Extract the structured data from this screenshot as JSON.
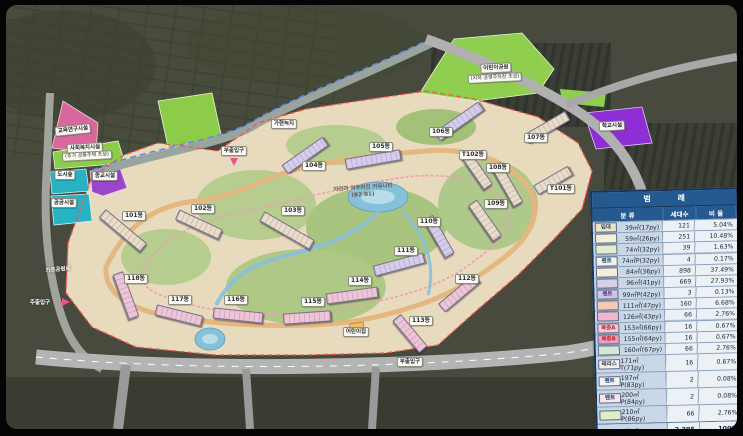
{
  "legend": {
    "title": "범 례",
    "columns": {
      "category": "분 류",
      "units": "세대수",
      "ratio": "비 율"
    },
    "rows": [
      {
        "chip": "임대",
        "chip_color": "#1d3f6e",
        "swatch": "#ece4c0",
        "area": "39㎡(17py)",
        "units": "121",
        "ratio": "5.04%"
      },
      {
        "chip": "",
        "chip_color": "",
        "swatch": "#f4eeda",
        "area": "59㎡(26py)",
        "units": "251",
        "ratio": "10.48%"
      },
      {
        "chip": "",
        "chip_color": "",
        "swatch": "#e2ecd0",
        "area": "74㎡(32py)",
        "units": "39",
        "ratio": "1.63%"
      },
      {
        "chip": "펜트",
        "chip_color": "#1d3f6e",
        "swatch": "#f2f2ee",
        "area": "74㎡P(32py)",
        "units": "4",
        "ratio": "0.17%"
      },
      {
        "chip": "",
        "chip_color": "",
        "swatch": "#f4eed4",
        "area": "84㎡(36py)",
        "units": "898",
        "ratio": "37.49%"
      },
      {
        "chip": "",
        "chip_color": "",
        "swatch": "#d6d0e8",
        "area": "96㎡(41py)",
        "units": "669",
        "ratio": "27.93%"
      },
      {
        "chip": "펜트",
        "chip_color": "#5b2d8e",
        "swatch": "#cec4e4",
        "area": "99㎡P(42py)",
        "units": "3",
        "ratio": "0.13%"
      },
      {
        "chip": "",
        "chip_color": "",
        "swatch": "#f4cbb0",
        "area": "111㎡(47py)",
        "units": "160",
        "ratio": "6.68%"
      },
      {
        "chip": "",
        "chip_color": "",
        "swatch": "#f0b6cd",
        "area": "126㎡(43py)",
        "units": "66",
        "ratio": "2.76%"
      },
      {
        "chip": "복층A",
        "chip_color": "#c0272d",
        "swatch": "#f4c9d8",
        "area": "153㎡(66py)",
        "units": "16",
        "ratio": "0.67%"
      },
      {
        "chip": "복층B",
        "chip_color": "#c0272d",
        "swatch": "#ee9fc2",
        "area": "155㎡(64py)",
        "units": "16",
        "ratio": "0.67%"
      },
      {
        "chip": "",
        "chip_color": "",
        "swatch": "#d2e8d4",
        "area": "160㎡(67py)",
        "units": "66",
        "ratio": "2.76%"
      },
      {
        "chip": "테라스",
        "chip_color": "#333344",
        "swatch": "#f2f2f0",
        "area": "171㎡T(71py)",
        "units": "16",
        "ratio": "0.67%"
      },
      {
        "chip": "펜트",
        "chip_color": "#1d3f6e",
        "swatch": "#f4f4f2",
        "area": "197㎡P(83py)",
        "units": "2",
        "ratio": "0.08%"
      },
      {
        "chip": "펜트",
        "chip_color": "#1d3f6e",
        "swatch": "#f6e7ee",
        "area": "200㎡P(84py)",
        "units": "2",
        "ratio": "0.08%"
      },
      {
        "chip": "",
        "chip_color": "",
        "swatch": "#def0c4",
        "area": "210㎡P(86py)",
        "units": "66",
        "ratio": "2.76%"
      }
    ],
    "total": {
      "label": "합 계",
      "units": "2,395",
      "ratio": "100%"
    }
  },
  "site": {
    "buildings": [
      {
        "label": "101동",
        "x": 128,
        "y": 211,
        "bx": 116,
        "by": 224,
        "rot": 40,
        "len": 52,
        "color": "#e9dcc8"
      },
      {
        "label": "102동",
        "x": 197,
        "y": 204,
        "bx": 192,
        "by": 218,
        "rot": 25,
        "len": 46,
        "color": "#e9dcc8"
      },
      {
        "label": "103동",
        "x": 287,
        "y": 206,
        "bx": 280,
        "by": 224,
        "rot": 30,
        "len": 56,
        "color": "#e9dcc8"
      },
      {
        "label": "104동",
        "x": 308,
        "y": 161,
        "bx": 298,
        "by": 149,
        "rot": -35,
        "len": 48,
        "color": "#d6cdea"
      },
      {
        "label": "105동",
        "x": 375,
        "y": 142,
        "bx": 366,
        "by": 153,
        "rot": -10,
        "len": 54,
        "color": "#d6cdea"
      },
      {
        "label": "106동",
        "x": 435,
        "y": 127,
        "bx": 452,
        "by": 115,
        "rot": -35,
        "len": 52,
        "color": "#d6cdea"
      },
      {
        "label": "107동",
        "x": 530,
        "y": 133,
        "bx": 540,
        "by": 121,
        "rot": -30,
        "len": 46,
        "color": "#e9dcc8"
      },
      {
        "label": "T102동",
        "x": 467,
        "y": 150,
        "bx": 470,
        "by": 164,
        "rot": 55,
        "len": 38,
        "color": "#e9dcc8"
      },
      {
        "label": "108동",
        "x": 492,
        "y": 163,
        "bx": 500,
        "by": 178,
        "rot": 60,
        "len": 44,
        "color": "#e9dcc8"
      },
      {
        "label": "T101동",
        "x": 555,
        "y": 184,
        "bx": 546,
        "by": 174,
        "rot": -30,
        "len": 38,
        "color": "#e9dcc8"
      },
      {
        "label": "109동",
        "x": 490,
        "y": 199,
        "bx": 478,
        "by": 214,
        "rot": 55,
        "len": 42,
        "color": "#e9dcc8"
      },
      {
        "label": "110동",
        "x": 423,
        "y": 217,
        "bx": 432,
        "by": 230,
        "rot": 60,
        "len": 42,
        "color": "#d6cdea"
      },
      {
        "label": "111동",
        "x": 400,
        "y": 246,
        "bx": 392,
        "by": 258,
        "rot": -15,
        "len": 50,
        "color": "#d6cdea"
      },
      {
        "label": "112동",
        "x": 461,
        "y": 274,
        "bx": 452,
        "by": 287,
        "rot": -40,
        "len": 44,
        "color": "#eec4d6"
      },
      {
        "label": "113동",
        "x": 415,
        "y": 316,
        "bx": 403,
        "by": 327,
        "rot": 50,
        "len": 40,
        "color": "#eec4d6"
      },
      {
        "label": "114동",
        "x": 354,
        "y": 276,
        "bx": 345,
        "by": 289,
        "rot": -8,
        "len": 50,
        "color": "#eec4d6"
      },
      {
        "label": "115동",
        "x": 307,
        "y": 297,
        "bx": 300,
        "by": 311,
        "rot": -4,
        "len": 46,
        "color": "#eec4d6"
      },
      {
        "label": "116동",
        "x": 230,
        "y": 295,
        "bx": 231,
        "by": 309,
        "rot": 6,
        "len": 48,
        "color": "#eec4d6"
      },
      {
        "label": "117동",
        "x": 174,
        "y": 295,
        "bx": 172,
        "by": 309,
        "rot": 14,
        "len": 46,
        "color": "#eec4d6"
      },
      {
        "label": "118동",
        "x": 130,
        "y": 274,
        "bx": 119,
        "by": 289,
        "rot": 70,
        "len": 46,
        "color": "#eec4d6"
      }
    ],
    "facilities": [
      {
        "label": "교육연구시설",
        "x": 67,
        "y": 125,
        "variant": "chip-sm",
        "rot": -6
      },
      {
        "label": "사회복지시설",
        "x": 79,
        "y": 143,
        "variant": "chip-sm",
        "rot": -3
      },
      {
        "label": "(추가 공동주택 조성)",
        "x": 81,
        "y": 151,
        "variant": "chip-xs",
        "rot": -3
      },
      {
        "label": "도시숲",
        "x": 59,
        "y": 170,
        "variant": "chip-sm",
        "rot": 0
      },
      {
        "label": "종교시설",
        "x": 99,
        "y": 171,
        "variant": "chip-sm",
        "rot": 0
      },
      {
        "label": "공공시설",
        "x": 58,
        "y": 198,
        "variant": "chip-sm",
        "rot": 0
      },
      {
        "label": "학교시설",
        "x": 606,
        "y": 121,
        "variant": "chip-sm",
        "rot": -3
      },
      {
        "label": "가현녹지",
        "x": 278,
        "y": 119,
        "variant": "chip-sm",
        "rot": 0
      },
      {
        "label": "어린이공원",
        "x": 490,
        "y": 63,
        "variant": "chip-sm",
        "rot": -3
      },
      {
        "label": "(지하 공영주차장 조성)",
        "x": 489,
        "y": 73,
        "variant": "chip-xs",
        "rot": -3
      },
      {
        "label": "어린이집",
        "x": 350,
        "y": 327,
        "variant": "chip-sm",
        "rot": 0
      },
      {
        "label": "자연과 어우러진 커뮤니티",
        "x": 357,
        "y": 182,
        "variant": "map-text",
        "rot": -4
      },
      {
        "label": "(B2·B1)",
        "x": 357,
        "y": 190,
        "variant": "map-text",
        "rot": -4
      },
      {
        "label": "가로공원로",
        "x": 52,
        "y": 264,
        "variant": "road-text",
        "rot": -6
      }
    ],
    "entrances": [
      {
        "label": "주출입구",
        "x": 34,
        "y": 297,
        "arrow": "right"
      },
      {
        "label": "부출입구",
        "x": 228,
        "y": 146,
        "arrow": "down"
      },
      {
        "label": "부출입구",
        "x": 404,
        "y": 357,
        "arrow": ""
      }
    ]
  }
}
